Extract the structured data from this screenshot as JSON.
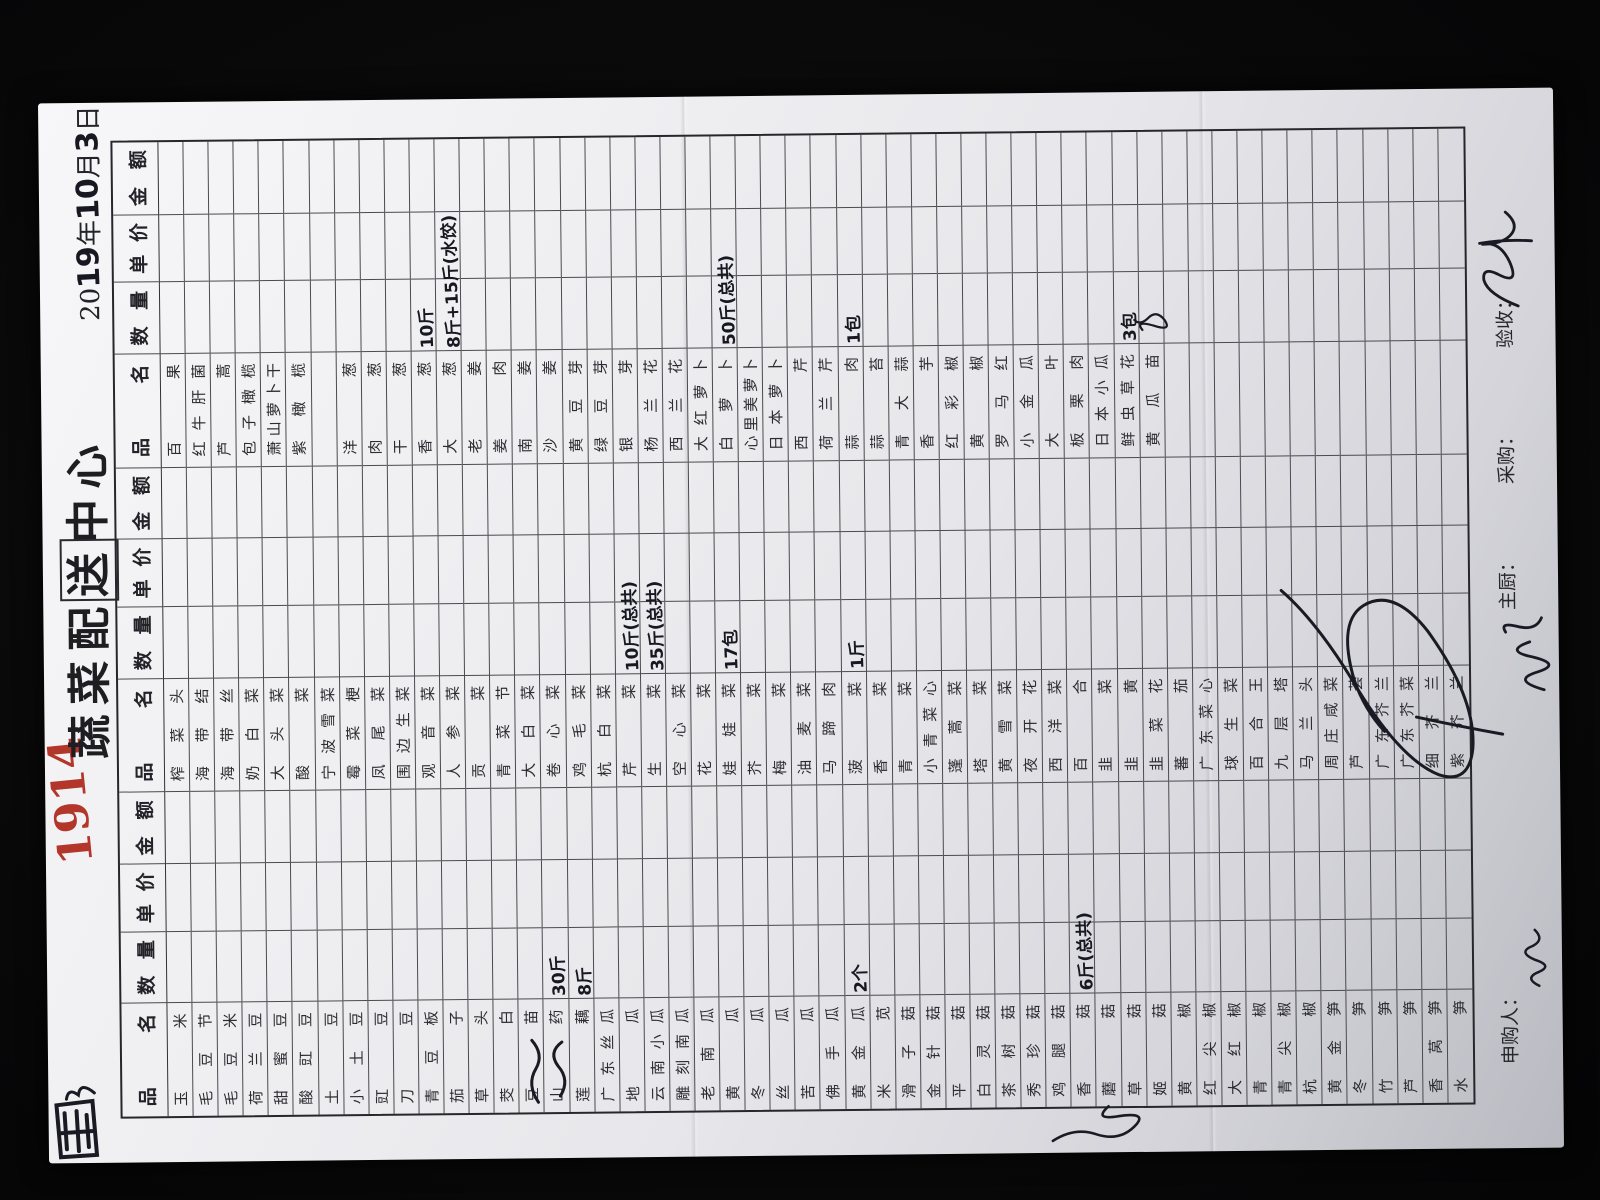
{
  "meta": {
    "store_number": "1914",
    "title": "蔬菜配送中心",
    "title_boxed_char_index": 3,
    "date": {
      "printed_prefix": "20",
      "year_handwritten": "19",
      "year_unit": "年",
      "month_handwritten": "10",
      "month_unit": "月",
      "day_handwritten": "3",
      "day_unit": "日",
      "full": "2019年10月3日"
    }
  },
  "colors": {
    "red_number": "#b3362a",
    "ink": "#181822",
    "grid": "#4a4a50",
    "paper": "#ececf0"
  },
  "table": {
    "row_count": 52,
    "header": {
      "name": "品 名",
      "qty": "数 量",
      "price": "单 价",
      "amount": "金 额"
    },
    "groups": [
      {
        "names": [
          "玉米",
          "毛豆节",
          "毛豆米",
          "荷兰豆",
          "甜蜜豆",
          "酸豇豆",
          "土豆",
          "小土豆",
          "豇豆",
          "刀豆",
          "青豆板",
          "茄子",
          "草头",
          "茭白",
          "豆苗",
          "山药",
          "莲藕",
          "广东丝瓜",
          "地瓜",
          "云南小瓜",
          "雕刻南瓜",
          "老南瓜",
          "黄瓜",
          "冬瓜",
          "丝瓜",
          "苦瓜",
          "佛手瓜",
          "黄金瓜",
          "米苋",
          "滑子菇",
          "金针菇",
          "平菇",
          "白灵菇",
          "茶树菇",
          "秀珍菇",
          "鸡腿菇",
          "香菇",
          "蘑菇",
          "草菇",
          "姬菇",
          "黄椒",
          "红尖椒",
          "大红椒",
          "青椒",
          "青尖椒",
          "杭椒",
          "黄金笋",
          "冬笋",
          "竹笋",
          "芦笋",
          "香莴笋",
          "水笋"
        ],
        "quantities": {
          "16": "30斤",
          "17": "8斤",
          "28": "2个",
          "37": "6斤(总共)"
        }
      },
      {
        "names": [
          "榨菜头",
          "海带结",
          "海带丝",
          "奶白菜",
          "大头菜",
          "酸菜",
          "宁波雪菜",
          "霉菜梗",
          "凤尾菜",
          "围边生菜",
          "观音菜",
          "人参菜",
          "贡菜",
          "青菜节",
          "大白菜",
          "卷心菜",
          "鸡毛菜",
          "杭白菜",
          "芹菜",
          "生菜",
          "空心菜",
          "花菜",
          "娃娃菜",
          "芥菜",
          "梅菜",
          "油麦菜",
          "马蹄肉",
          "菠菜",
          "香菜",
          "青菜",
          "小青菜心",
          "蓬蒿菜",
          "塔菜",
          "黄雪菜",
          "夜开花",
          "西洋菜",
          "百合",
          "韭菜",
          "韭黄",
          "韭菜花",
          "蕃茄",
          "广东菜心",
          "球生菜",
          "百合王",
          "九层塔",
          "马兰头",
          "周庄咸菜",
          "芦荟",
          "广东芥兰",
          "广东芥菜",
          "细芥兰",
          "紫芥兰"
        ],
        "quantities": {
          "19": "10斤(总共)",
          "20": "35斤(总共)",
          "23": "17包",
          "28": "1斤"
        }
      },
      {
        "names": [
          "百果",
          "红牛肝菌",
          "芦蒿",
          "包子橄榄",
          "萧山萝卜干",
          "紫橄榄",
          "",
          "洋葱",
          "肉葱",
          "干葱",
          "香葱",
          "大葱",
          "老姜",
          "姜肉",
          "南姜",
          "沙姜",
          "黄豆芽",
          "绿豆芽",
          "银芽",
          "杨兰花",
          "西兰花",
          "大红萝卜",
          "白萝卜",
          "心里美萝卜",
          "日本萝卜",
          "西芹",
          "荷兰芹",
          "蒜肉",
          "蒜苔",
          "青大蒜",
          "香芋",
          "红彩椒",
          "黄椒",
          "罗马红",
          "小金瓜",
          "大叶",
          "板栗肉",
          "日本小瓜",
          "鲜虫草花",
          "黄瓜苗",
          "",
          "",
          "",
          "",
          "",
          "",
          "",
          "",
          "",
          "",
          "",
          ""
        ],
        "quantities": {
          "11": "10斤",
          "12": "8斤+15斤(水饺)",
          "23": "50斤(总共)",
          "28": "1包",
          "39": "3包"
        }
      }
    ]
  },
  "footer": {
    "requester_label": "申购人：",
    "chef_label": "主厨：",
    "buyer_label": "采购：",
    "inspector_label": "验收："
  },
  "annotations": {
    "top_left_mark": "bold boxed scribble",
    "store_number_note": "handwritten red order number",
    "yam_margin_scribble": "correction scrawl beside 山药 row",
    "left_margin_scrawl": "signature scrawl on left margin",
    "buyer_circle_mark": "large oval scrawl over bottom rows",
    "chef_signature": "cursive scrawl before 主厨 label",
    "requester_signature": "small scrawl after 申购人 label",
    "inspector_signature": "cursive signature after 验收 label",
    "cucumber_seedling_qty_mark": "tiny illegible quantity scribble"
  }
}
